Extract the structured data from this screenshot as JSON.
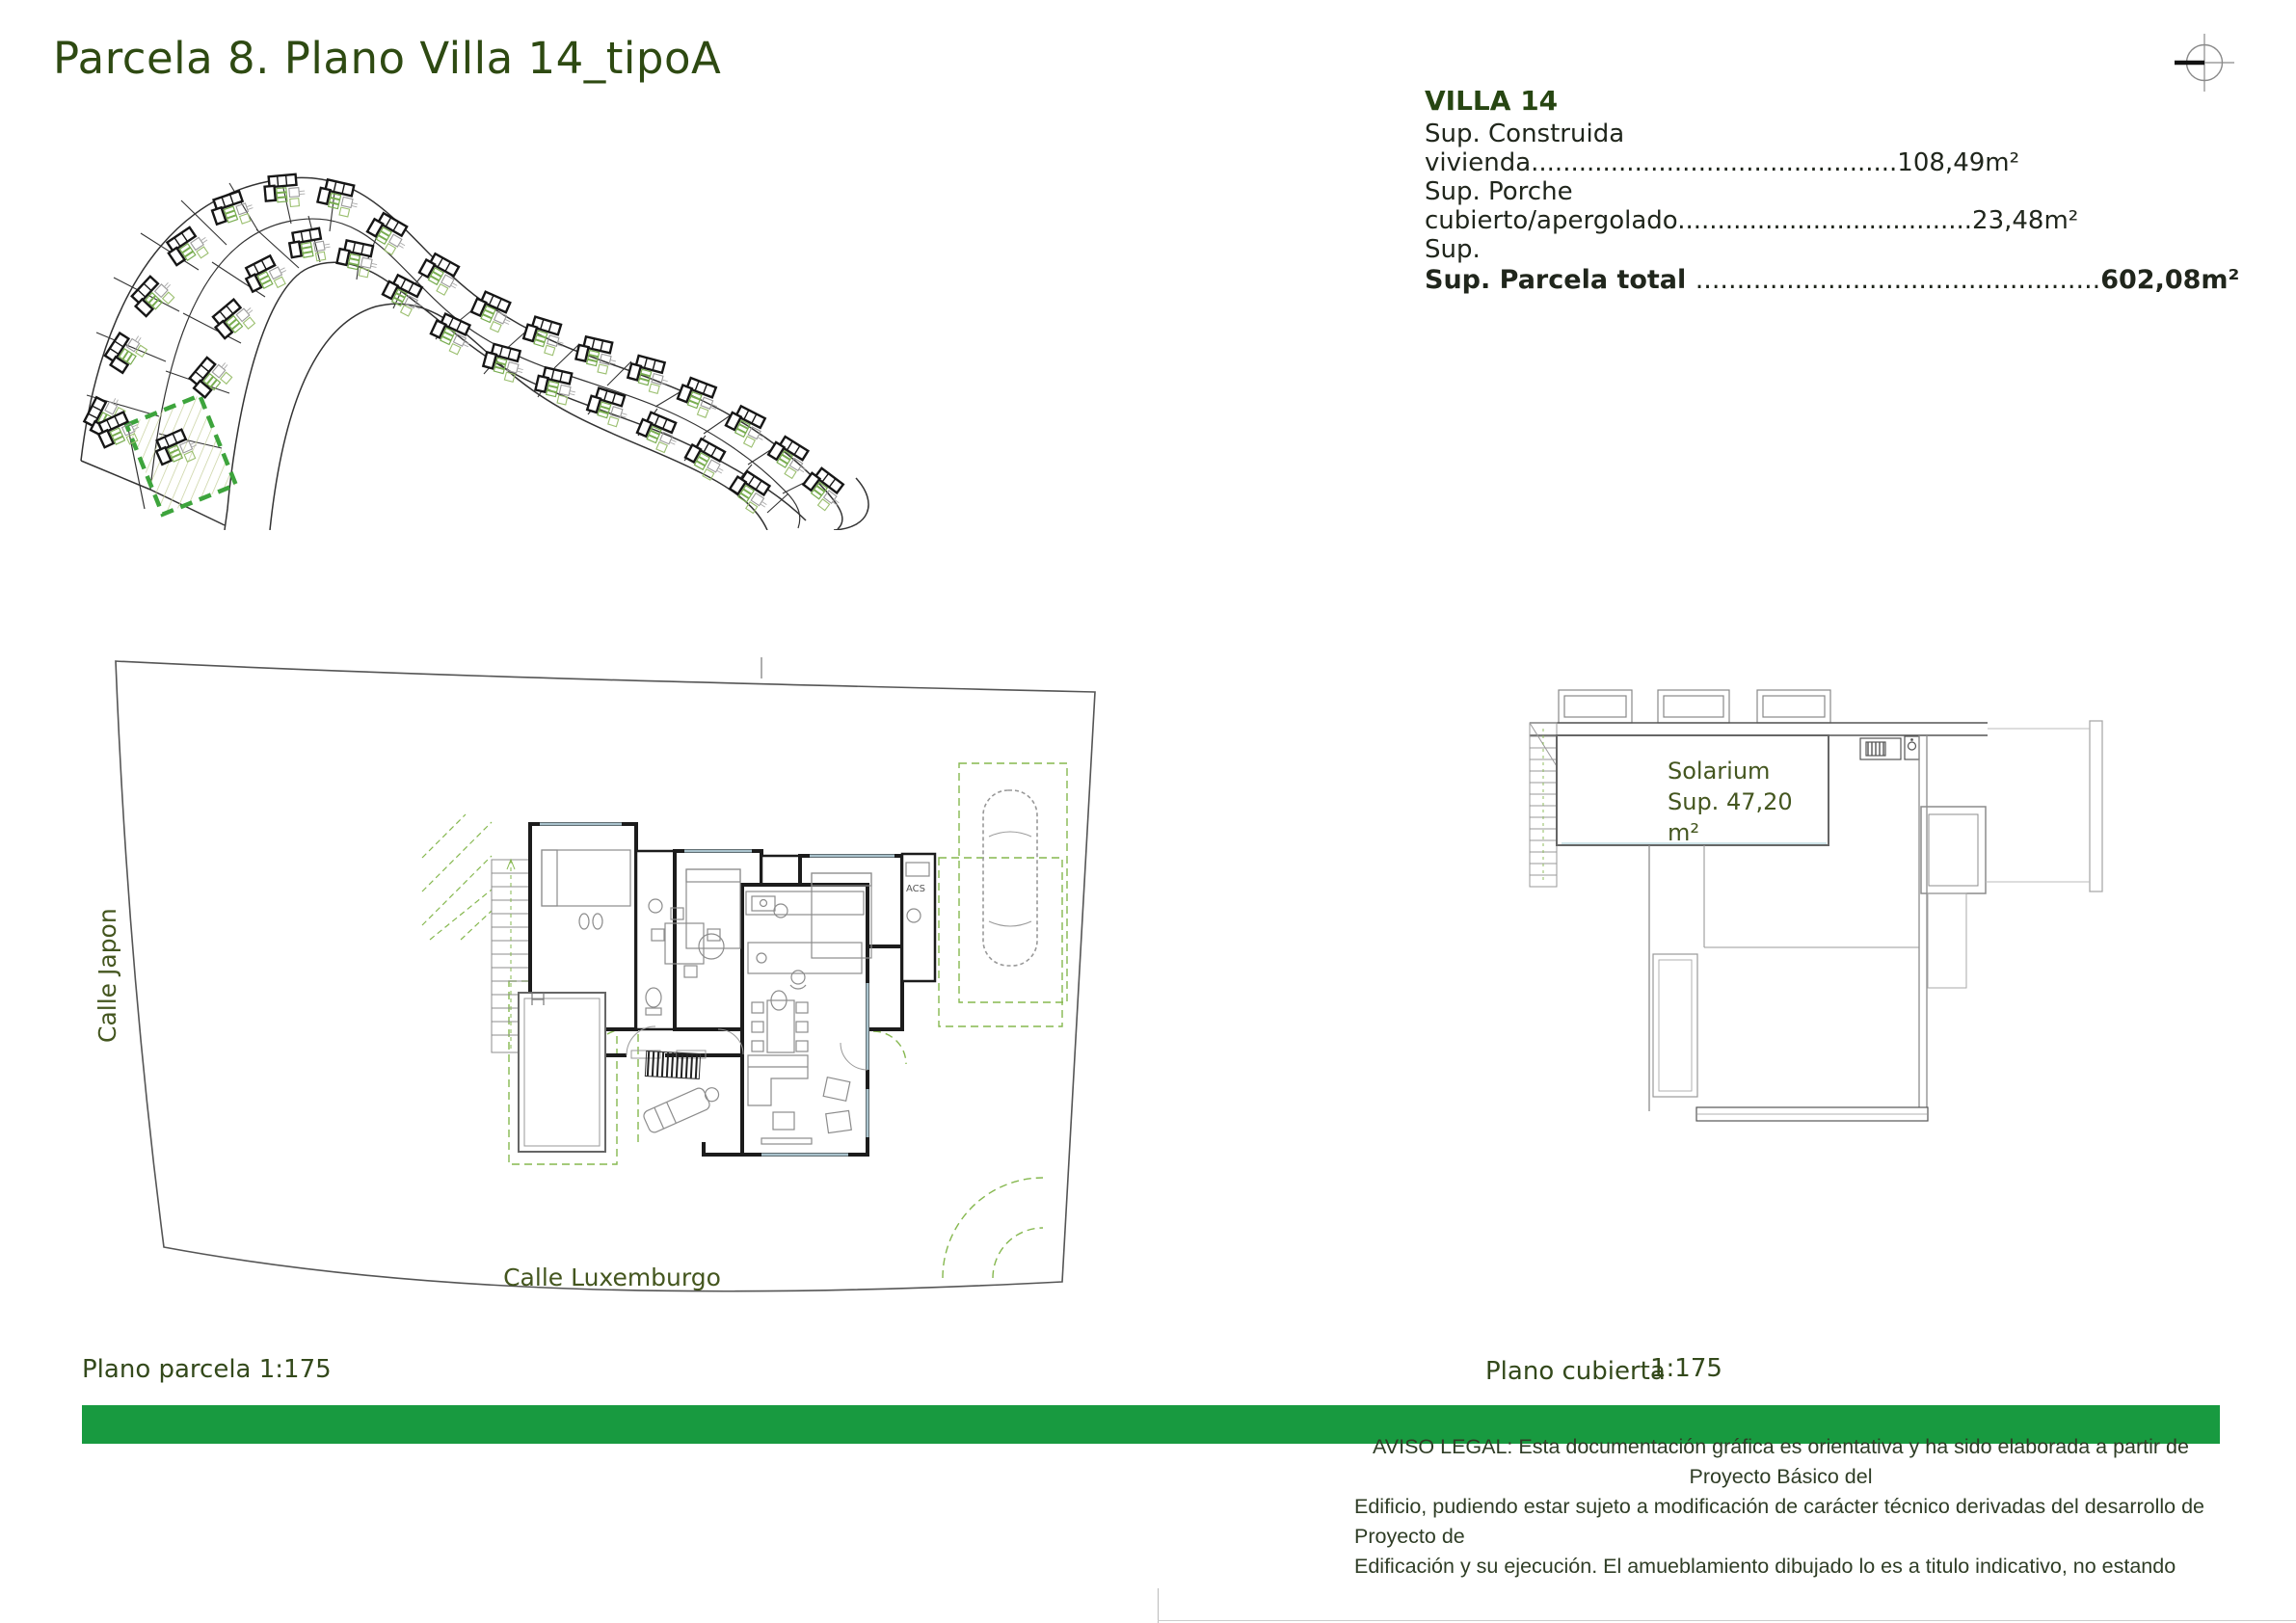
{
  "page": {
    "title": "Parcela 8. Plano Villa 14_tipoA"
  },
  "info_panel": {
    "heading": "VILLA 14",
    "construida_label": "Sup. Construida",
    "construida_value": "vivienda..............................................108,49m²",
    "porche_label": "Sup. Porche",
    "porche_value": "cubierto/apergolado.....................................23,48m²",
    "sup_label": "Sup.",
    "total_label": "Sup. Parcela total",
    "total_dots": ".................................................",
    "total_value": "602,08m²"
  },
  "floor_plan": {
    "street_left": "Calle Japon",
    "street_bottom": "Calle Luxemburgo",
    "utility_label": "ACS",
    "caption": "Plano parcela 1:175"
  },
  "roof_plan": {
    "solarium_line1": "Solarium",
    "solarium_line2": "Sup. 47,20",
    "solarium_line3": "m²",
    "caption": "Plano cubierta",
    "scale": "1:175"
  },
  "footer": {
    "bar_color": "#189a40",
    "legal_line1": "AVISO LEGAL: Esta documentación gráfica es orientativa y ha sido elaborada a partir de",
    "legal_line2": "Proyecto Básico del",
    "legal_line3": "Edificio, pudiendo estar sujeto a modificación de carácter técnico derivadas del desarrollo de",
    "legal_line4": "Proyecto de",
    "legal_line5": "Edificación y su ejecución. El amueblamiento dibujado lo es a titulo indicativo, no estando"
  },
  "colors": {
    "accent_green": "#189a40",
    "highlight_green": "#3da43c",
    "title_green": "#2e4a12"
  }
}
